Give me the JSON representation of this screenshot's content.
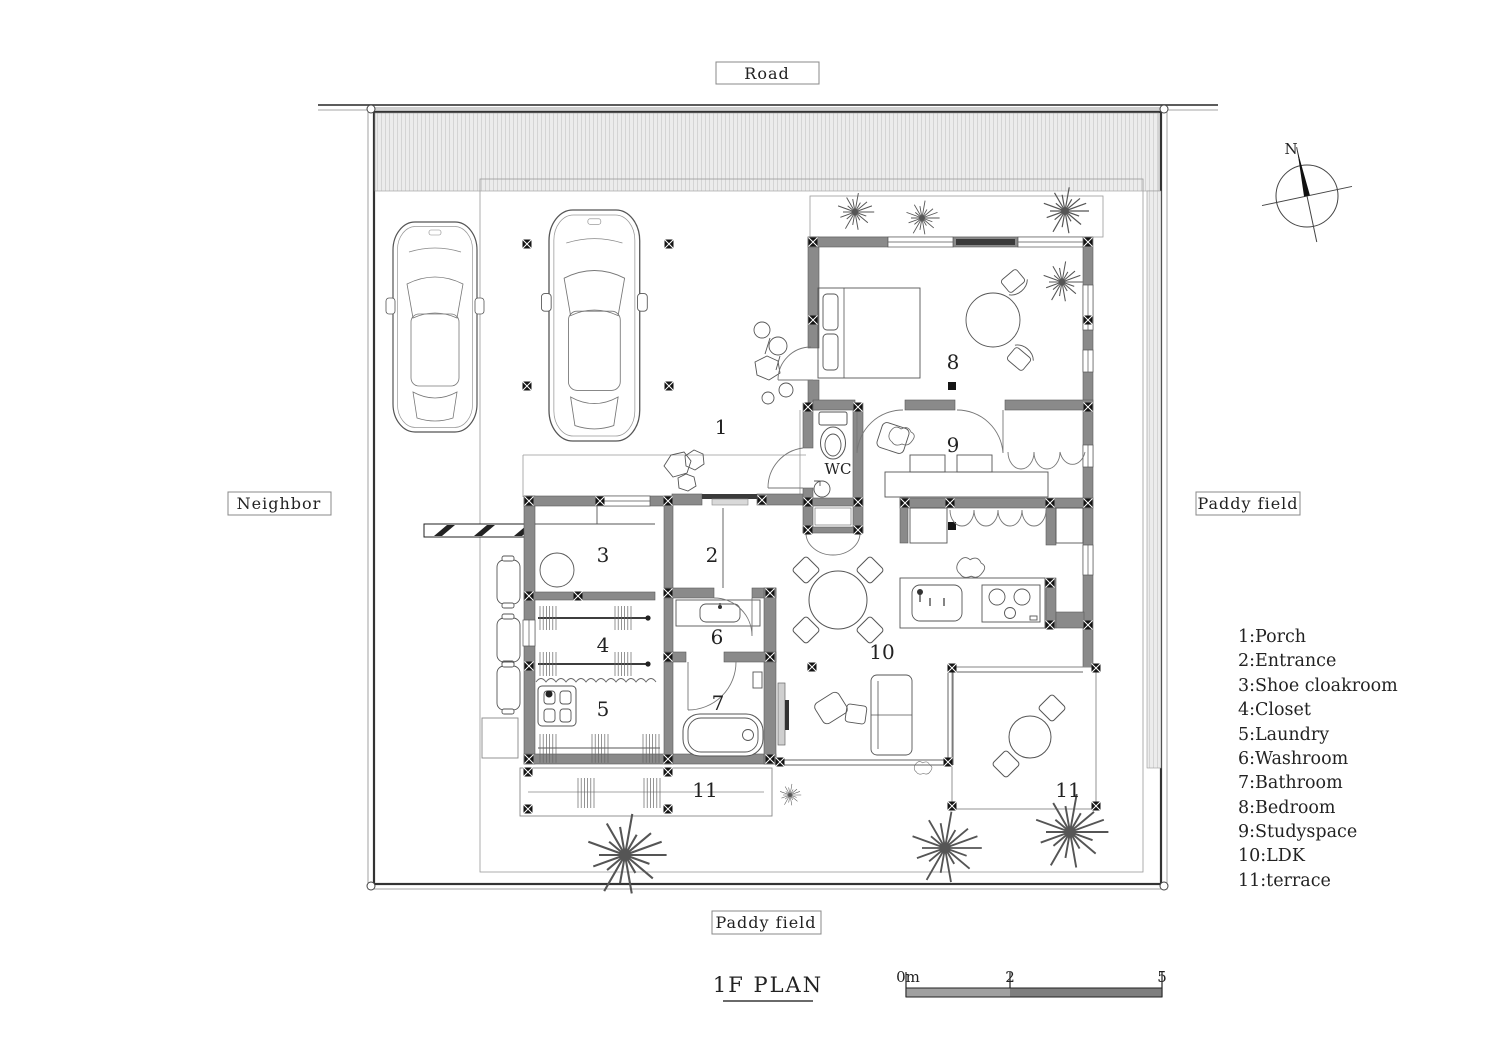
{
  "surroundings": {
    "road": "Road",
    "neighbor": "Neighbor",
    "paddy_right": "Paddy field",
    "paddy_bottom": "Paddy field"
  },
  "title": "1F PLAN",
  "compass_label": "N",
  "scale_bar": {
    "t0": "0m",
    "t2": "2",
    "t5": "5"
  },
  "wc_label": "WC",
  "rooms": [
    {
      "num": "1",
      "name": "Porch",
      "legend": "1:Porch"
    },
    {
      "num": "2",
      "name": "Entrance",
      "legend": "2:Entrance"
    },
    {
      "num": "3",
      "name": "Shoe cloakroom",
      "legend": "3:Shoe cloakroom"
    },
    {
      "num": "4",
      "name": "Closet",
      "legend": "4:Closet"
    },
    {
      "num": "5",
      "name": "Laundry",
      "legend": "5:Laundry"
    },
    {
      "num": "6",
      "name": "Washroom",
      "legend": "6:Washroom"
    },
    {
      "num": "7",
      "name": "Bathroom",
      "legend": "7:Bathroom"
    },
    {
      "num": "8",
      "name": "Bedroom",
      "legend": "8:Bedroom"
    },
    {
      "num": "9",
      "name": "Studyspace",
      "legend": "9:Studyspace"
    },
    {
      "num": "10",
      "name": "LDK",
      "legend": "10:LDK"
    },
    {
      "num": "11",
      "name": "terrace",
      "legend": "11:terrace"
    }
  ],
  "colors": {
    "wall_gray": "#8a8a8a",
    "hatch_bg": "#ececec",
    "hatch_line": "#cfcfcf",
    "scale_seg_light": "#a0a0a0",
    "scale_seg_dark": "#7e7e7e",
    "line": "#333333"
  }
}
